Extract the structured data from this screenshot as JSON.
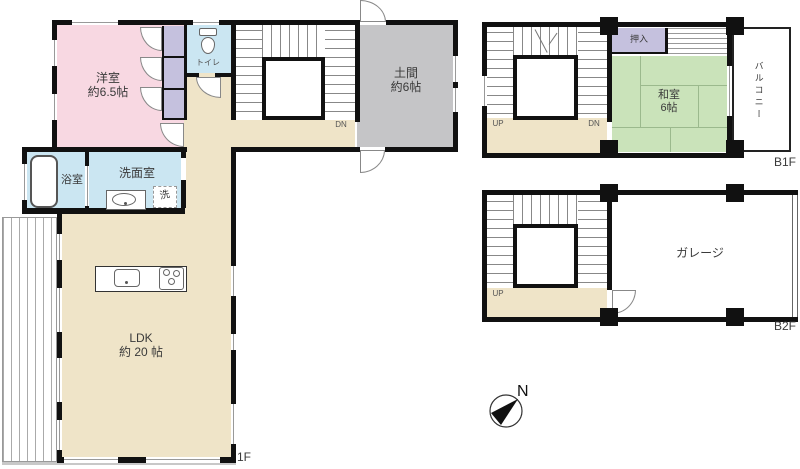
{
  "colors": {
    "wall": "#111111",
    "western_room": "#F8D8E2",
    "water_rooms": "#CBE6F2",
    "closet": "#C5C1DE",
    "flooring": "#EFE4C8",
    "doma": "#C5C5C7",
    "tatami_room": "#CAE3BA"
  },
  "floor_1f": {
    "floor_label": "1F",
    "western_room": {
      "name": "洋室",
      "size": "約6.5帖"
    },
    "toilet": {
      "name": "トイレ"
    },
    "doma": {
      "name": "土間",
      "size": "約6帖"
    },
    "bath": {
      "name": "浴室"
    },
    "washroom": {
      "name": "洗面室"
    },
    "laundry": {
      "name": "洗"
    },
    "ldk": {
      "name": "LDK",
      "size": "約 20 帖"
    },
    "stairs": {
      "dn": "DN"
    }
  },
  "floor_b1f": {
    "floor_label": "B1F",
    "closet": {
      "name": "押入"
    },
    "japanese_room": {
      "name": "和室",
      "size": "6帖"
    },
    "balcony": {
      "name": "バルコニー"
    },
    "stairs": {
      "up": "UP",
      "dn": "DN"
    }
  },
  "floor_b2f": {
    "floor_label": "B2F",
    "garage": {
      "name": "ガレージ"
    },
    "stairs": {
      "up": "UP"
    }
  },
  "compass": {
    "north": "N"
  }
}
